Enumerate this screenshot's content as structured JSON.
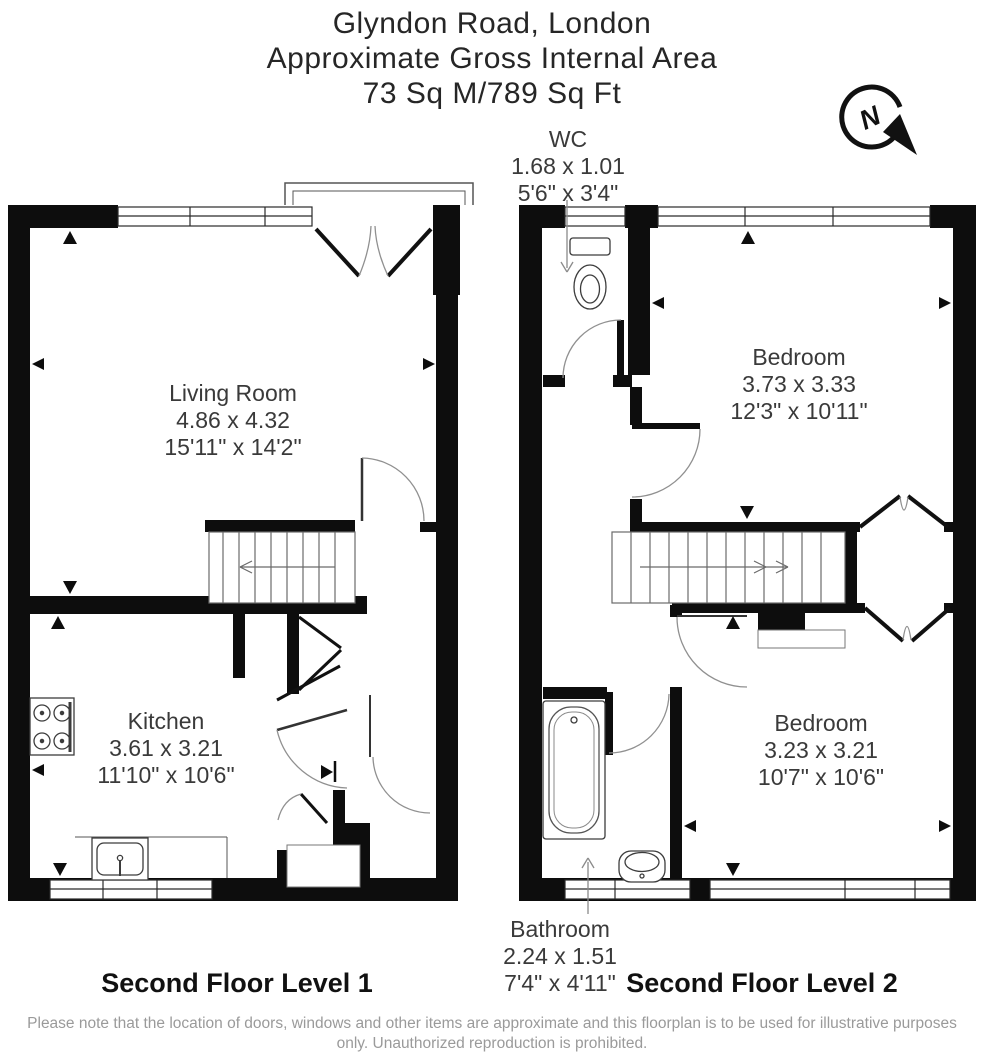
{
  "title": {
    "line1": "Glyndon Road, London",
    "line2": "Approximate Gross Internal Area",
    "line3": "73 Sq M/789 Sq Ft"
  },
  "compass": {
    "letter": "N"
  },
  "plans": [
    {
      "level_label": "Second Floor Level 1",
      "rooms": {
        "living_room": {
          "name": "Living Room",
          "metric": "4.86 x 4.32",
          "imperial": "15'11\" x 14'2\""
        },
        "kitchen": {
          "name": "Kitchen",
          "metric": "3.61 x 3.21",
          "imperial": "11'10\" x 10'6\""
        }
      }
    },
    {
      "level_label": "Second Floor Level 2",
      "rooms": {
        "wc": {
          "name": "WC",
          "metric": "1.68 x 1.01",
          "imperial": "5'6\" x 3'4\""
        },
        "bedroom_1": {
          "name": "Bedroom",
          "metric": "3.73 x 3.33",
          "imperial": "12'3\" x 10'11\""
        },
        "bedroom_2": {
          "name": "Bedroom",
          "metric": "3.23 x 3.21",
          "imperial": "10'7\" x 10'6\""
        },
        "bathroom": {
          "name": "Bathroom",
          "metric": "2.24 x 1.51",
          "imperial": "7'4\" x 4'11\""
        }
      }
    }
  ],
  "footer": {
    "disclaimer": "Please note that the location of doors, windows and other items are approximate and this floorplan is to be used for illustrative purposes only. Unauthorized reproduction is prohibited."
  }
}
